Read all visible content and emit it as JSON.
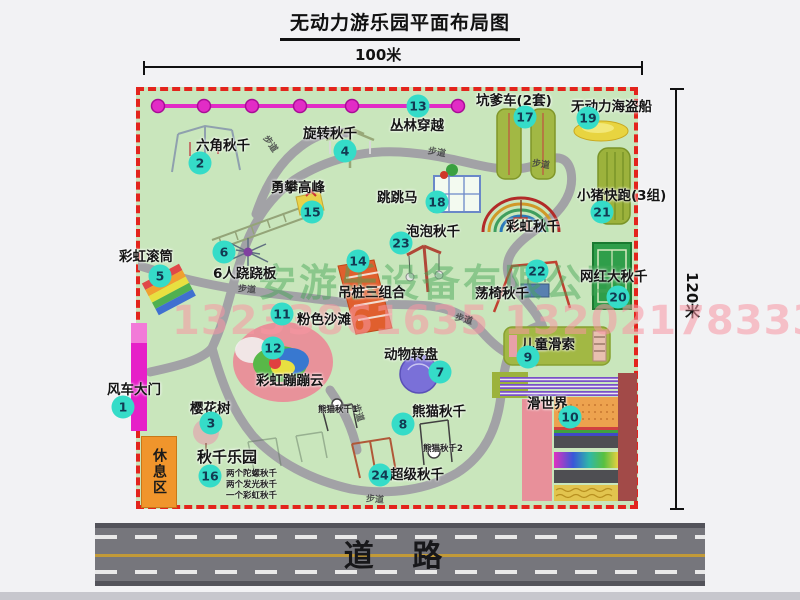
{
  "title": "无动力游乐园平面布局图",
  "dimensions": {
    "width_label": "100米",
    "height_label": "120米"
  },
  "road": {
    "label": "道  路"
  },
  "watermark": {
    "company": "安游乐设备有限公司",
    "phone": "13233861635 13202178333"
  },
  "colors": {
    "map_green": "#c9e6bc",
    "border_red": "#e3241c",
    "badge_teal": "#35dcc8",
    "gate_magenta": "#e620c8",
    "zipline_magenta": "#e22cc6",
    "rest_area_orange": "#f0952c",
    "road_gray": "#76767c",
    "road_yellow": "#c29a38",
    "path_gray": "#a2a2a6"
  },
  "attractions": [
    {
      "num": "1",
      "label": "风车大门"
    },
    {
      "num": "2",
      "label": "六角秋千"
    },
    {
      "num": "3",
      "label": "樱花树"
    },
    {
      "num": "4",
      "label": "旋转秋千"
    },
    {
      "num": "5",
      "label": "彩虹滚筒"
    },
    {
      "num": "6",
      "label": "6人跷跷板"
    },
    {
      "num": "7",
      "label": "动物转盘"
    },
    {
      "num": "8",
      "label": "熊猫秋千"
    },
    {
      "num": "9",
      "label": "儿童滑索"
    },
    {
      "num": "10",
      "label": "滑世界"
    },
    {
      "num": "11",
      "label": "粉色沙滩"
    },
    {
      "num": "12",
      "label": "彩虹蹦蹦云"
    },
    {
      "num": "13",
      "label": "丛林穿越"
    },
    {
      "num": "14",
      "label": "吊桩三组合"
    },
    {
      "num": "15",
      "label": "勇攀高峰"
    },
    {
      "num": "16",
      "label": "秋千乐园"
    },
    {
      "num": "17",
      "label": "坑爹车(2套)"
    },
    {
      "num": "18",
      "label": "跳跳马"
    },
    {
      "num": "19",
      "label": "无动力海盗船"
    },
    {
      "num": "20",
      "label": "网红大秋千"
    },
    {
      "num": "21",
      "label": "小猪快跑(3组)"
    },
    {
      "num": "22",
      "label": "荡椅秋千"
    },
    {
      "num": "23",
      "label": "泡泡秋千"
    },
    {
      "num": "24",
      "label": "超级秋千"
    }
  ],
  "extra_labels": {
    "rainbow_swing": "彩虹秋千",
    "rest_area": "休息区",
    "panda_swing_1": "熊猫秋千1",
    "panda_swing_2": "熊猫秋千2",
    "walkway": "步道",
    "swing_park_details": [
      "两个陀螺秋千",
      "两个发光秋千",
      "一个彩虹秋千"
    ]
  }
}
